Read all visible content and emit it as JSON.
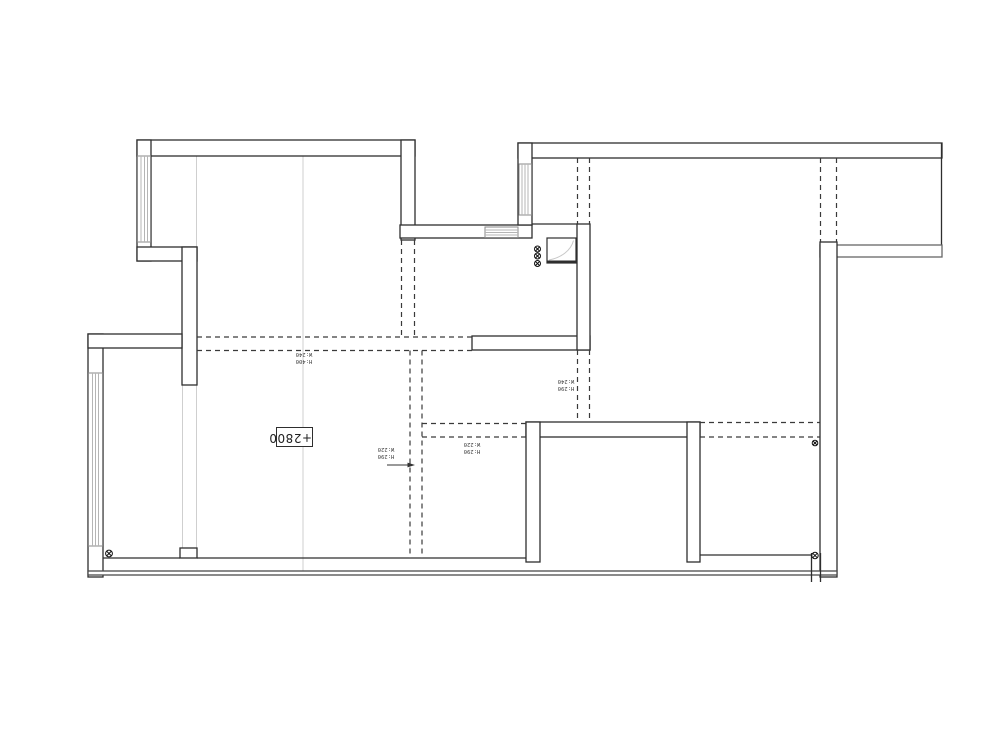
{
  "drawing": {
    "type": "floor-plan",
    "level_annotation": "+2800"
  },
  "beam_labels": {
    "b1": {
      "line1": "H:400",
      "line2": "W:240"
    },
    "b2": {
      "line1": "H:290",
      "line2": "W:240"
    },
    "b3": {
      "line1": "H:290",
      "line2": "W:220"
    },
    "b4": {
      "line1": "H:290",
      "line2": "W:220"
    }
  },
  "symbols": {
    "circle_cross_count": 6,
    "meaning": "circle-cross-marker"
  },
  "colors": {
    "wall": "#2e2e2e",
    "beam_dash": "#3a3a3a",
    "window": "#8a8a8a",
    "underlay": "#cfcfcf",
    "label": "#3c3c3c",
    "background": "#ffffff"
  }
}
